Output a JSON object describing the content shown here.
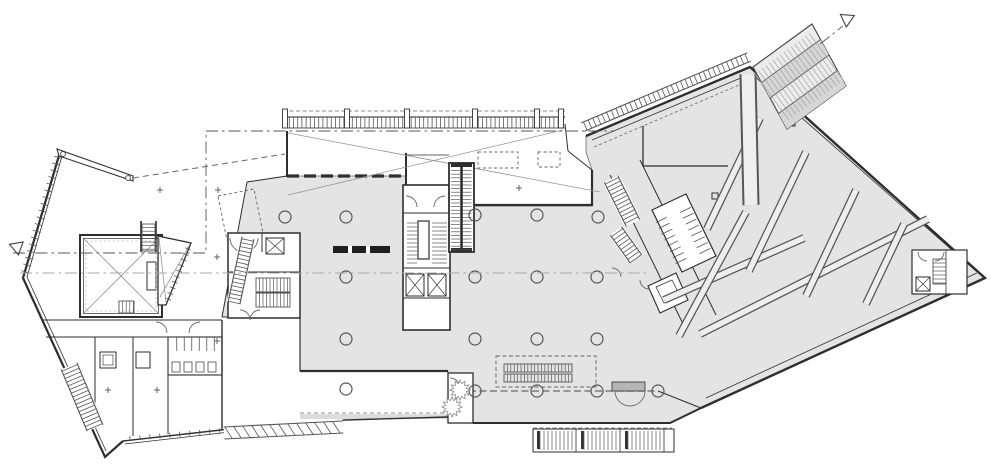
{
  "drawing": {
    "kind": "architectural-floor-plan",
    "sheet_background": "#ffffff"
  },
  "colors": {
    "paper": "#ffffff",
    "floor": "#e4e4e4",
    "stripe": "#d6d6d6",
    "canopy": "#ececec",
    "wall": "#2e2e2e",
    "line": "#565656",
    "thin": "#949494",
    "mat": "#b5b5b5",
    "desk": "#1f1f1f",
    "plinth": "#dcdcdc",
    "brace": "#eeeeee",
    "gridline_light": "#a8a8a8"
  },
  "columns": {
    "radius": 6,
    "positions": [
      [
        285,
        217
      ],
      [
        346,
        217
      ],
      [
        475,
        215
      ],
      [
        537,
        215
      ],
      [
        598,
        217
      ],
      [
        346,
        277
      ],
      [
        475,
        277
      ],
      [
        537,
        277
      ],
      [
        597,
        277
      ],
      [
        346,
        339
      ],
      [
        475,
        339
      ],
      [
        537,
        339
      ],
      [
        597,
        339
      ],
      [
        475,
        391
      ],
      [
        537,
        391
      ],
      [
        597,
        391
      ],
      [
        658,
        391
      ],
      [
        346,
        389
      ]
    ]
  },
  "gridlines": [
    {
      "name": "setout-line-left",
      "points": "13,253 206,253 206,131",
      "tone": "dark"
    },
    {
      "name": "setout-line-top",
      "points": "206,131 615,131",
      "tone": "dark"
    },
    {
      "name": "setout-line-mid",
      "points": "20,273 650,273",
      "tone": "light"
    },
    {
      "name": "setout-line-canopy",
      "points": "820,44 843,26",
      "tone": "dark"
    }
  ],
  "markers": [
    {
      "name": "section-marker-west",
      "cx": 17,
      "cy": 247,
      "r": 8,
      "angle": 80
    },
    {
      "name": "section-marker-northeast",
      "cx": 847,
      "cy": 19,
      "r": 8,
      "angle": 215
    }
  ],
  "braces": [
    {
      "x1": 700,
      "y1": 334,
      "x2": 928,
      "y2": 219
    },
    {
      "x1": 664,
      "y1": 300,
      "x2": 804,
      "y2": 238
    },
    {
      "x1": 760,
      "y1": 118,
      "x2": 707,
      "y2": 229
    },
    {
      "x1": 806,
      "y1": 152,
      "x2": 749,
      "y2": 271
    },
    {
      "x1": 856,
      "y1": 190,
      "x2": 806,
      "y2": 296
    },
    {
      "x1": 904,
      "y1": 224,
      "x2": 866,
      "y2": 304
    },
    {
      "x1": 746,
      "y1": 212,
      "x2": 679,
      "y2": 336
    },
    {
      "x1": 748,
      "y1": 74,
      "x2": 751,
      "y2": 205,
      "cw": 17,
      "fw": 13
    }
  ],
  "ladders": [
    {
      "name": "north-canopy-rungs",
      "x1": 283,
      "y1": 122.5,
      "x2": 563,
      "y2": 122.5,
      "width": 11,
      "step": 4.2,
      "rails": [
        -5.5,
        5.5
      ]
    },
    {
      "name": "west-wall-hatch",
      "x1": 59,
      "y1": 154,
      "x2": 24,
      "y2": 276,
      "width": 8,
      "step": 7,
      "rails": []
    },
    {
      "name": "southwest-canopy-hatch",
      "x1": 224,
      "y1": 433,
      "x2": 343,
      "y2": 427,
      "width": 12,
      "step": 9,
      "rails": [
        -6,
        6
      ],
      "skew": 7,
      "back": true
    },
    {
      "name": "wing-northwest-canopy",
      "x1": 583,
      "y1": 127,
      "x2": 749,
      "y2": 57,
      "width": 9,
      "step": 5,
      "rails": [
        -4.5,
        4.5
      ],
      "back": true
    },
    {
      "name": "southwest-facade-ticks",
      "x1": 125,
      "y1": 439,
      "x2": 228,
      "y2": 430,
      "width": 5,
      "step": 10,
      "rails": []
    },
    {
      "name": "trapezoid-edge-ticks",
      "x1": 189,
      "y1": 246,
      "x2": 167,
      "y2": 302,
      "width": 6,
      "step": 6,
      "rails": []
    },
    {
      "name": "junction-stair-upper",
      "x1": 611,
      "y1": 179,
      "x2": 633,
      "y2": 223,
      "width": 15,
      "step": 4,
      "rails": [
        -7.5,
        7.5
      ],
      "back": true
    },
    {
      "name": "junction-stair-lower",
      "x1": 616,
      "y1": 231,
      "x2": 636,
      "y2": 259,
      "width": 14,
      "step": 4,
      "rails": [
        -7,
        7
      ],
      "back": true
    },
    {
      "name": "southwest-diagonal-stair",
      "x1": 69,
      "y1": 366,
      "x2": 95,
      "y2": 428,
      "width": 17,
      "step": 4,
      "rails": [
        -8.5,
        8.5
      ],
      "back": true
    },
    {
      "name": "west-core-ramp",
      "x1": 248,
      "y1": 238,
      "x2": 234,
      "y2": 303,
      "width": 12,
      "step": 4,
      "rails": [
        -6,
        6
      ],
      "back": true
    },
    {
      "name": "junction-toilet-stalls-a",
      "x1": 660,
      "y1": 217,
      "x2": 681,
      "y2": 261,
      "width": 12,
      "step": 6.5,
      "rails": []
    },
    {
      "name": "junction-toilet-stalls-b",
      "x1": 684,
      "y1": 207,
      "x2": 705,
      "y2": 251,
      "width": 12,
      "step": 6.5,
      "rails": []
    },
    {
      "name": "leftwing-toilet-stalls",
      "x1": 173,
      "y1": 344,
      "x2": 219,
      "y2": 344,
      "width": 14,
      "step": 7.5,
      "rails": []
    },
    {
      "name": "grid-canopy-rungs",
      "x1": 770,
      "y1": 98,
      "x2": 829,
      "y2": 55,
      "width": 58,
      "step": 4.5,
      "rails": [],
      "stroke": "#9a9a9a",
      "rw": 0.6
    }
  ],
  "stairs": [
    {
      "name": "escalator-north-a",
      "x": 451,
      "y": 167,
      "w": 9,
      "h": 83,
      "dir": "h",
      "step": 3.6
    },
    {
      "name": "escalator-north-b",
      "x": 462.5,
      "y": 167,
      "w": 9,
      "h": 83,
      "dir": "h",
      "step": 3.6
    },
    {
      "name": "escalator-south-a",
      "x": 504,
      "y": 364,
      "w": 68,
      "h": 8,
      "dir": "v",
      "step": 3.4,
      "box": true
    },
    {
      "name": "escalator-south-b",
      "x": 504,
      "y": 374,
      "w": 68,
      "h": 8,
      "dir": "v",
      "step": 3.4,
      "box": true
    },
    {
      "name": "core-stair-run-a",
      "x": 407,
      "y": 219,
      "w": 10,
      "h": 45,
      "dir": "h",
      "step": 4
    },
    {
      "name": "core-stair-run-b",
      "x": 432,
      "y": 219,
      "w": 15,
      "h": 45,
      "dir": "h",
      "step": 4
    },
    {
      "name": "westcore-stair-run-a",
      "x": 256,
      "y": 278,
      "w": 34,
      "h": 14,
      "dir": "v",
      "step": 3.5,
      "box": true
    },
    {
      "name": "westcore-stair-run-b",
      "x": 256,
      "y": 293,
      "w": 34,
      "h": 14,
      "dir": "v",
      "step": 3.5,
      "box": true
    },
    {
      "name": "hall-north-stair",
      "x": 142,
      "y": 224,
      "w": 13,
      "h": 27,
      "dir": "h",
      "step": 3.6,
      "box": true
    },
    {
      "name": "hall-southeast-stair",
      "x": 119,
      "y": 301,
      "w": 15,
      "h": 12,
      "dir": "v",
      "step": 3.6,
      "box": true
    },
    {
      "name": "terrace-stair-run-1",
      "x": 536,
      "y": 431,
      "w": 38,
      "h": 19,
      "dir": "v",
      "step": 4
    },
    {
      "name": "terrace-stair-run-2",
      "x": 580,
      "y": 431,
      "w": 38,
      "h": 19,
      "dir": "v",
      "step": 4
    },
    {
      "name": "terrace-stair-run-3",
      "x": 624,
      "y": 431,
      "w": 38,
      "h": 19,
      "dir": "v",
      "step": 4
    },
    {
      "name": "wing-tip-stair",
      "x": 933,
      "y": 259,
      "w": 13,
      "h": 25,
      "dir": "h",
      "step": 4,
      "box": true
    }
  ],
  "survey_marks": [
    [
      160,
      190
    ],
    [
      218,
      190
    ],
    [
      217,
      257
    ],
    [
      217,
      341
    ],
    [
      108,
      390
    ],
    [
      157,
      390
    ],
    [
      519,
      188
    ]
  ],
  "canopy_posts": {
    "xs": [
      285,
      347,
      407,
      475,
      537,
      561
    ],
    "y": 109,
    "w": 5,
    "h": 19
  },
  "ruffles": [
    [
      460,
      390
    ],
    [
      452,
      407
    ]
  ]
}
